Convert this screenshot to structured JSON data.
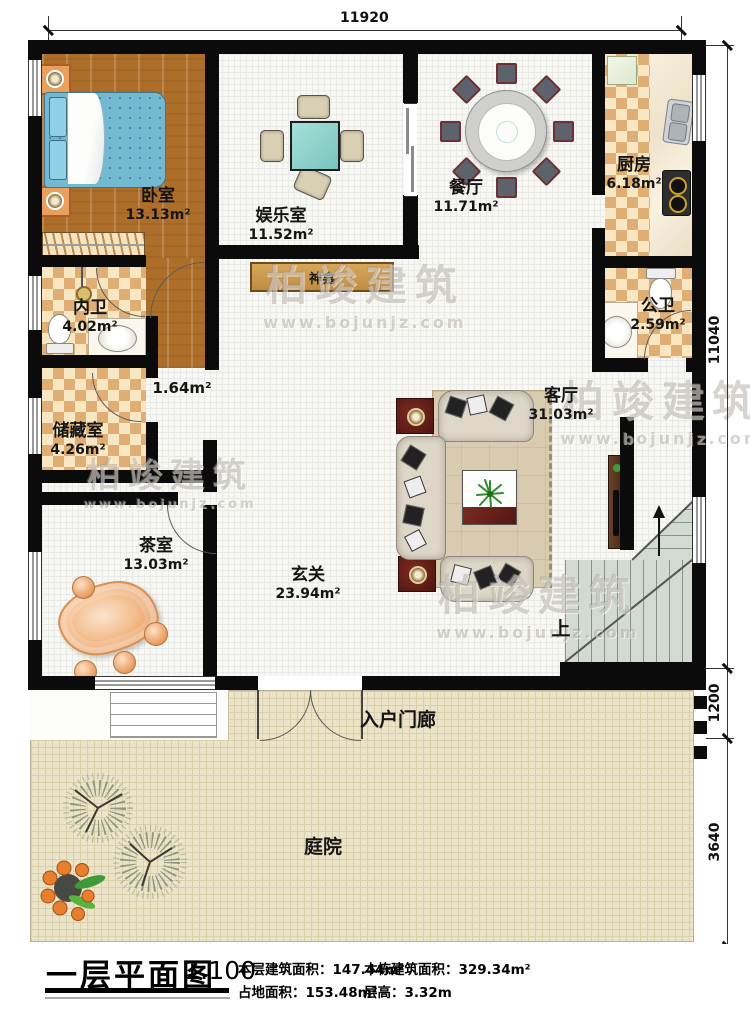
{
  "title_block": {
    "title": "一层平面图",
    "scale": "1:100",
    "stats": [
      {
        "label": "本层建筑面积：",
        "value": "147.44m²"
      },
      {
        "label": "本栋建筑面积：",
        "value": "329.34m²"
      },
      {
        "label": "占地面积：",
        "value": "153.48m²"
      },
      {
        "label": "层高：",
        "value": "3.32m"
      }
    ]
  },
  "dimensions": {
    "top_width": "11920",
    "right_house": "11040",
    "right_porch": "1200",
    "right_courtyard": "3640"
  },
  "rooms": {
    "bedroom": {
      "name": "卧室",
      "area": "13.13m²"
    },
    "game_room": {
      "name": "娱乐室",
      "area": "11.52m²"
    },
    "dining_room": {
      "name": "餐厅",
      "area": "11.71m²"
    },
    "kitchen": {
      "name": "厨房",
      "area": "6.18m²"
    },
    "inner_bath": {
      "name": "内卫",
      "area": "4.02m²"
    },
    "public_bath": {
      "name": "公卫",
      "area": "2.59m²"
    },
    "storage": {
      "name": "储藏室",
      "area": "4.26m²"
    },
    "tea_room": {
      "name": "茶室",
      "area": "13.03m²"
    },
    "living_room": {
      "name": "客厅",
      "area": "31.03m²"
    },
    "foyer": {
      "name": "玄关",
      "area": "23.94m²"
    },
    "porch": {
      "name": "入户门廊"
    },
    "courtyard": {
      "name": "庭院"
    }
  },
  "annotations": {
    "hallway_area": "1.64m²",
    "shrine": "神龛",
    "stairs_up": "上"
  },
  "watermark": {
    "brand": "柏竣建筑",
    "url": "www.bojunjz.com"
  },
  "colors": {
    "wall": "#0b0b0b",
    "wood_floor": "#ad6e2a",
    "checker_dark": "#dfae74",
    "checker_light": "#f8e7c2",
    "courtyard_floor": "#ece4c8",
    "table_teal": "#8ed2cc",
    "bed_teal": "#74b9d2",
    "stairs": "#d3dbd0",
    "tea_table_orange": "#eda96f",
    "tv_cabinet": "#4f2f1f"
  }
}
